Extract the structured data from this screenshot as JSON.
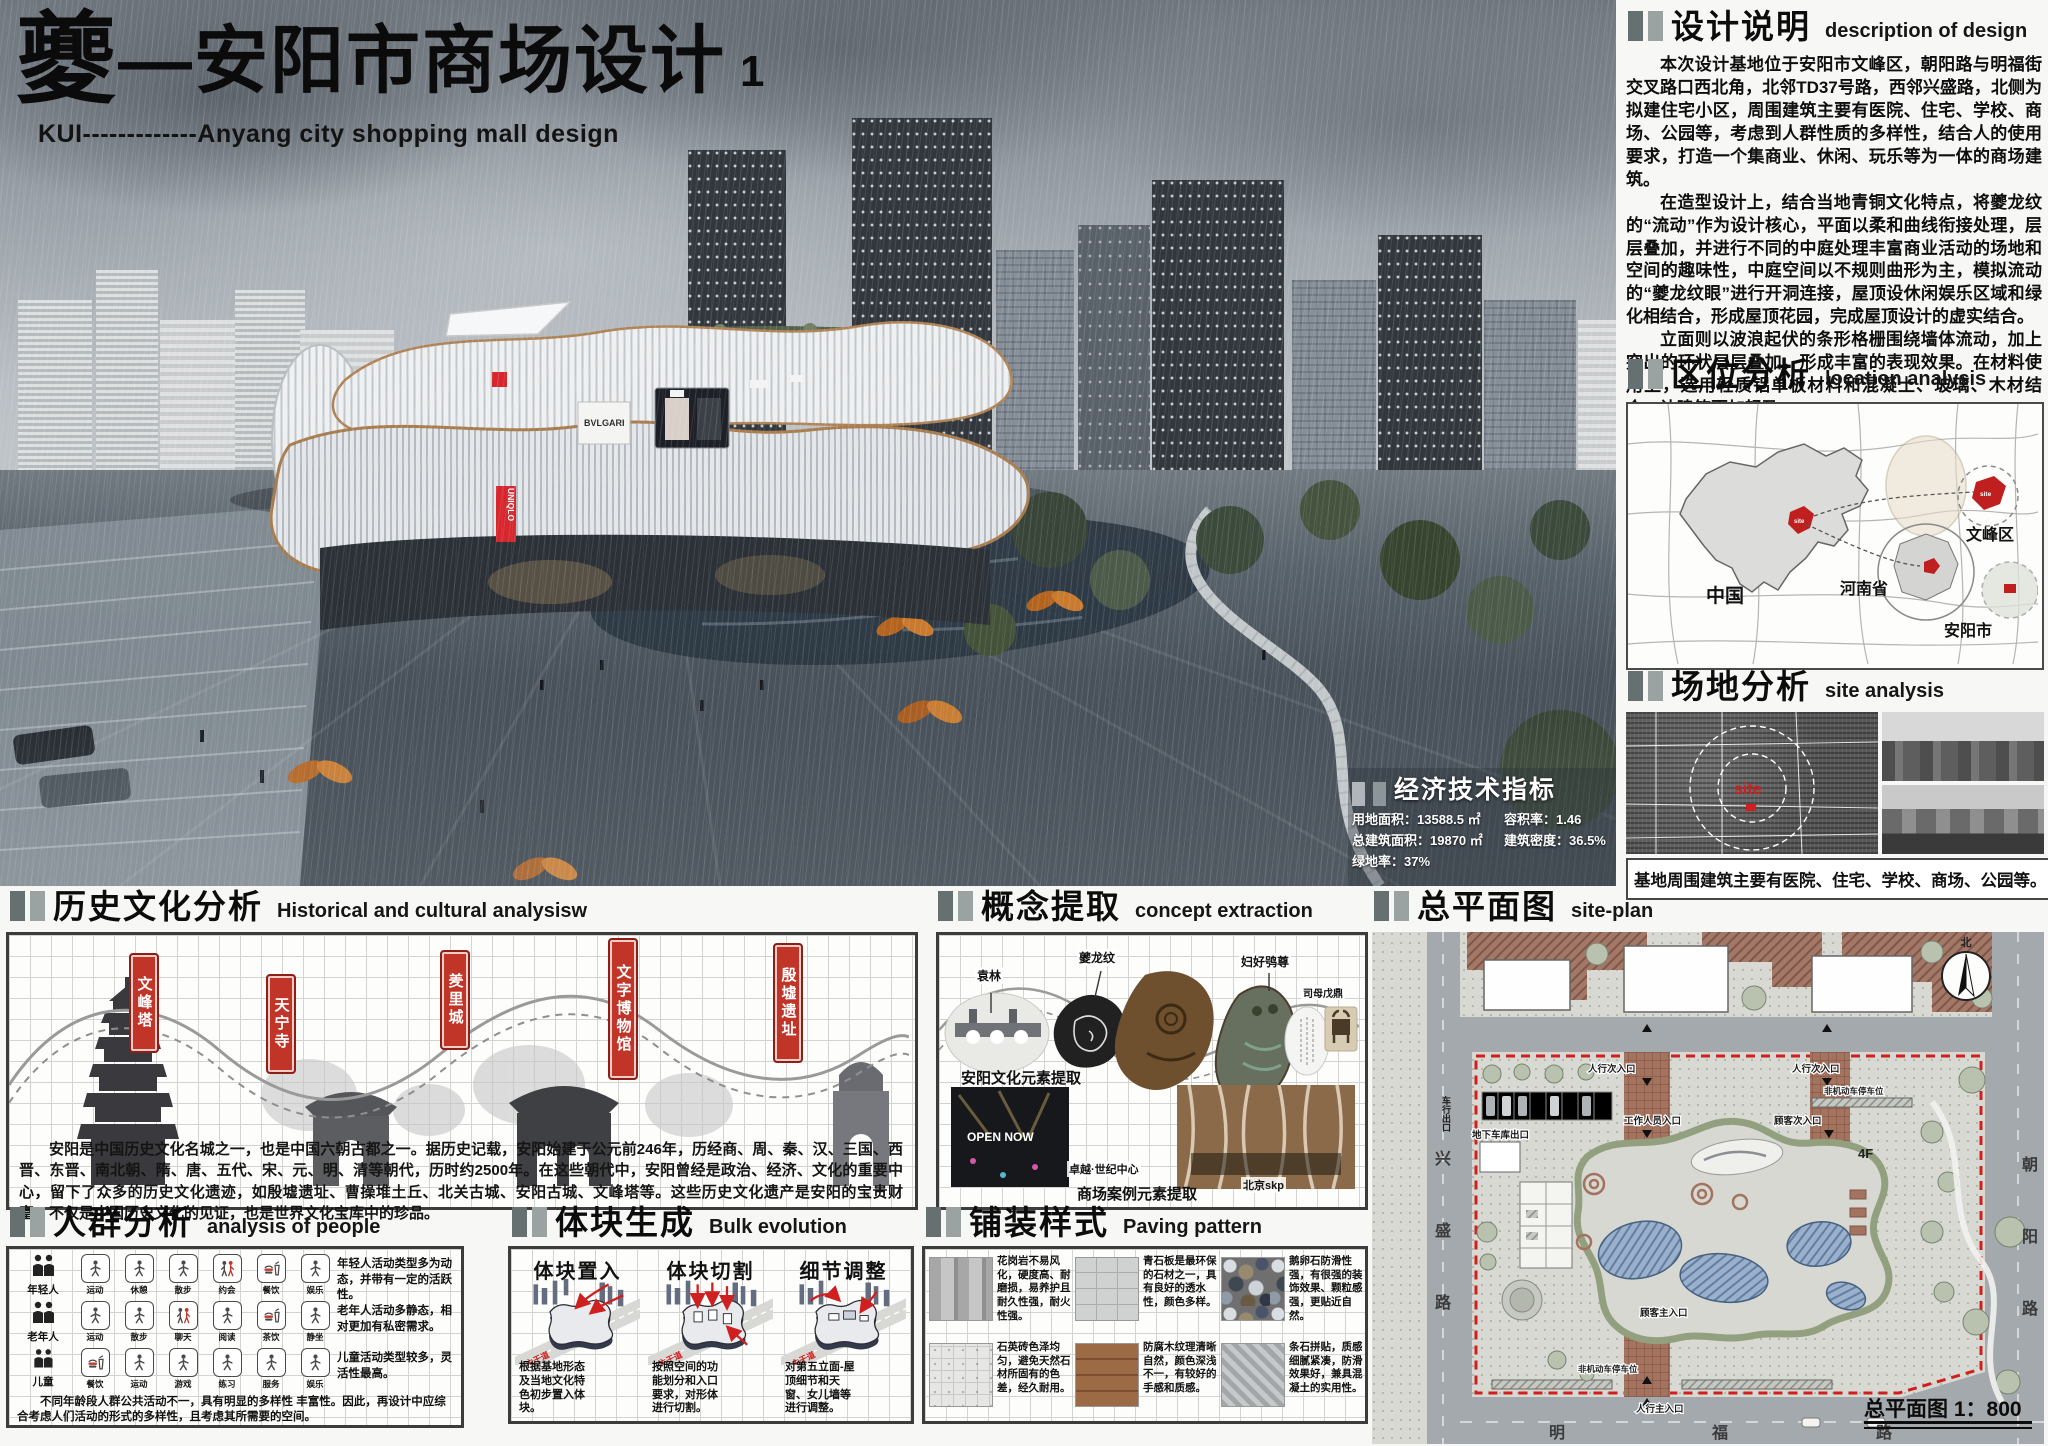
{
  "board": {
    "title_cn_first": "夔",
    "title_cn_rest": "—安阳市商场设计",
    "title_no": "1",
    "subtitle": "KUI-------------Anyang city shopping mall design"
  },
  "render": {
    "uniqlo": "UNIQLO",
    "bvlgari": "BVLGARI"
  },
  "design_desc": {
    "title": "设计说明",
    "subtitle": "description of design",
    "p1": "本次设计基地位于安阳市文峰区，朝阳路与明福街交叉路口西北角，北邻TD37号路，西邻兴盛路，北侧为拟建住宅小区，周围建筑主要有医院、住宅、学校、商场、公园等，考虑到人群性质的多样性，结合人的使用要求，打造一个集商业、休闲、玩乐等为一体的商场建筑。",
    "p2": "在造型设计上，结合当地青铜文化特点，将夔龙纹的“流动”作为设计核心，平面以柔和曲线衔接处理，层层叠加，并进行不同的中庭处理丰富商业活动的场地和空间的趣味性，中庭空间以不规则曲形为主，模拟流动的“夔龙纹眼”进行开洞连接，屋顶设休闲娱乐区域和绿化相结合，形成屋顶花园，完成屋顶设计的虚实结合。",
    "p3": "立面则以波浪起伏的条形格栅围绕墙体流动，加上突出的环状层层叠加，形成丰富的表现效果。在材料使用上，选用轻质铝单板材料和混凝土、玻璃、木材结合，让建筑更加轻盈。"
  },
  "location": {
    "title": "区位分析",
    "subtitle": "location analysis",
    "china": "中国",
    "henan": "河南省",
    "wenfeng": "文峰区",
    "anyang": "安阳市",
    "site": "site"
  },
  "site_analysis": {
    "title": "场地分析",
    "subtitle": "site analysis",
    "site": "site",
    "caption": "基地周围建筑主要有医院、住宅、学校、商场、公园等。"
  },
  "econ": {
    "title": "经济技术指标",
    "lines": [
      "用地面积：13588.5 ㎡",
      "容积率：1.46",
      "总建筑面积：19870 ㎡",
      "建筑密度：36.5%",
      "绿地率：37%"
    ]
  },
  "history": {
    "title": "历史文化分析",
    "subtitle": "Historical and cultural analysisw",
    "tags": [
      "文峰塔",
      "天宁寺",
      "羑里城",
      "文字博物馆",
      "殷墟遗址"
    ],
    "text": "安阳是中国历史文化名城之一，也是中国六朝古都之一。据历史记载，安阳始建于公元前246年，历经商、周、秦、汉、三国、西晋、东晋、南北朝、隋、唐、五代、宋、元、明、清等朝代，历时约2500年。在这些朝代中，安阳曾经是政治、经济、文化的重要中心，留下了众多的历史文化遗迹，如殷墟遗址、曹操堆土丘、北关古城、安阳古城、文峰塔等。这些历史文化遗产是安阳的宝贵财富，不仅是中国历史文化的见证，也是世界文化宝库中的珍品。"
  },
  "concept": {
    "title": "概念提取",
    "subtitle": "concept extraction",
    "labels": {
      "yuanlin": "袁林",
      "kuilongwen": "夔龙纹",
      "fuhao": "妇好鸮尊",
      "ding": "司母戊鼎"
    },
    "caption_top": "安阳文化元素提取",
    "caption_bottom": "商场案例元素提取",
    "cases": {
      "opennow": "OPEN NOW",
      "zhuoyue": "卓越·世纪中心",
      "skp": "北京skp"
    }
  },
  "people": {
    "title": "人群分析",
    "subtitle": "analysis of people",
    "rows": [
      {
        "group": "年轻人",
        "acts": [
          "运动",
          "休憩",
          "散步",
          "约会",
          "餐饮",
          "娱乐"
        ],
        "note": "年轻人活动类型多为动态，并带有一定的活跃性。"
      },
      {
        "group": "老年人",
        "acts": [
          "运动",
          "散步",
          "聊天",
          "阅读",
          "茶饮",
          "静坐"
        ],
        "note": "老年人活动多静态，相对更加有私密需求。"
      },
      {
        "group": "儿童",
        "acts": [
          "餐饮",
          "运动",
          "游戏",
          "练习",
          "服务",
          "娱乐"
        ],
        "note": "儿童活动类型较多，灵活性最高。"
      }
    ],
    "summary": "不同年龄段人群公共活动不一，具有明显的多样性 丰富性。因此，再设计中应综合考虑人们活动的形式的多样性，且考虑其所需要的空间。"
  },
  "bulk": {
    "title": "体块生成",
    "subtitle": "Bulk evolution",
    "road": "主干道",
    "steps": [
      {
        "name": "体块置入",
        "desc": "根据基地形态及当地文化特色初步置入体块。"
      },
      {
        "name": "体块切割",
        "desc": "按照空间的功能划分和入口要求，对形体进行切割。"
      },
      {
        "name": "细节调整",
        "desc": "对第五立面-屋顶细节和天窗、女儿墙等进行调整。"
      }
    ]
  },
  "paving": {
    "title": "铺装样式",
    "subtitle": "Paving pattern",
    "items": [
      {
        "name": "granite",
        "desc": "花岗岩不易风化，硬度高、耐磨损，易养护且耐久性强，耐火性强。"
      },
      {
        "name": "bluestone",
        "desc": "青石板是最环保的石材之一，具有良好的透水性，颜色多样。"
      },
      {
        "name": "pebble",
        "desc": "鹅卵石防滑性强，有很强的装饰效果、颗粒感强，更贴近自然。"
      },
      {
        "name": "quartz-brick",
        "desc": "石英砖色泽均匀，避免天然石材所固有的色差，经久耐用。"
      },
      {
        "name": "wood",
        "desc": "防腐木纹理清晰自然，颜色深浅不一，有较好的手感和质感。"
      },
      {
        "name": "strip-stone",
        "desc": "条石拼贴，质感细腻紧凑，防滑效果好，兼具混凝土的实用性。"
      }
    ]
  },
  "siteplan": {
    "title": "总平面图",
    "subtitle": "site-plan",
    "scale": "总平面图 1：800",
    "north": "北",
    "floor": "4F",
    "roads": {
      "left": [
        "兴",
        "盛",
        "路"
      ],
      "right": [
        "朝",
        "阳",
        "路"
      ],
      "bottom": [
        "明",
        "福",
        "路"
      ]
    },
    "labels": {
      "ped_sec1": "人行次入口",
      "ped_sec2": "人行次入口",
      "car_exit": "车行出口",
      "garage": "地下车库出口",
      "staff": "工作人员入口",
      "cust_sec": "顾客次入口",
      "bike_top": "非机动车停车位",
      "cust_main": "顾客主入口",
      "bike_bottom": "非机动车停车位",
      "ped_main": "人行主入口"
    }
  }
}
